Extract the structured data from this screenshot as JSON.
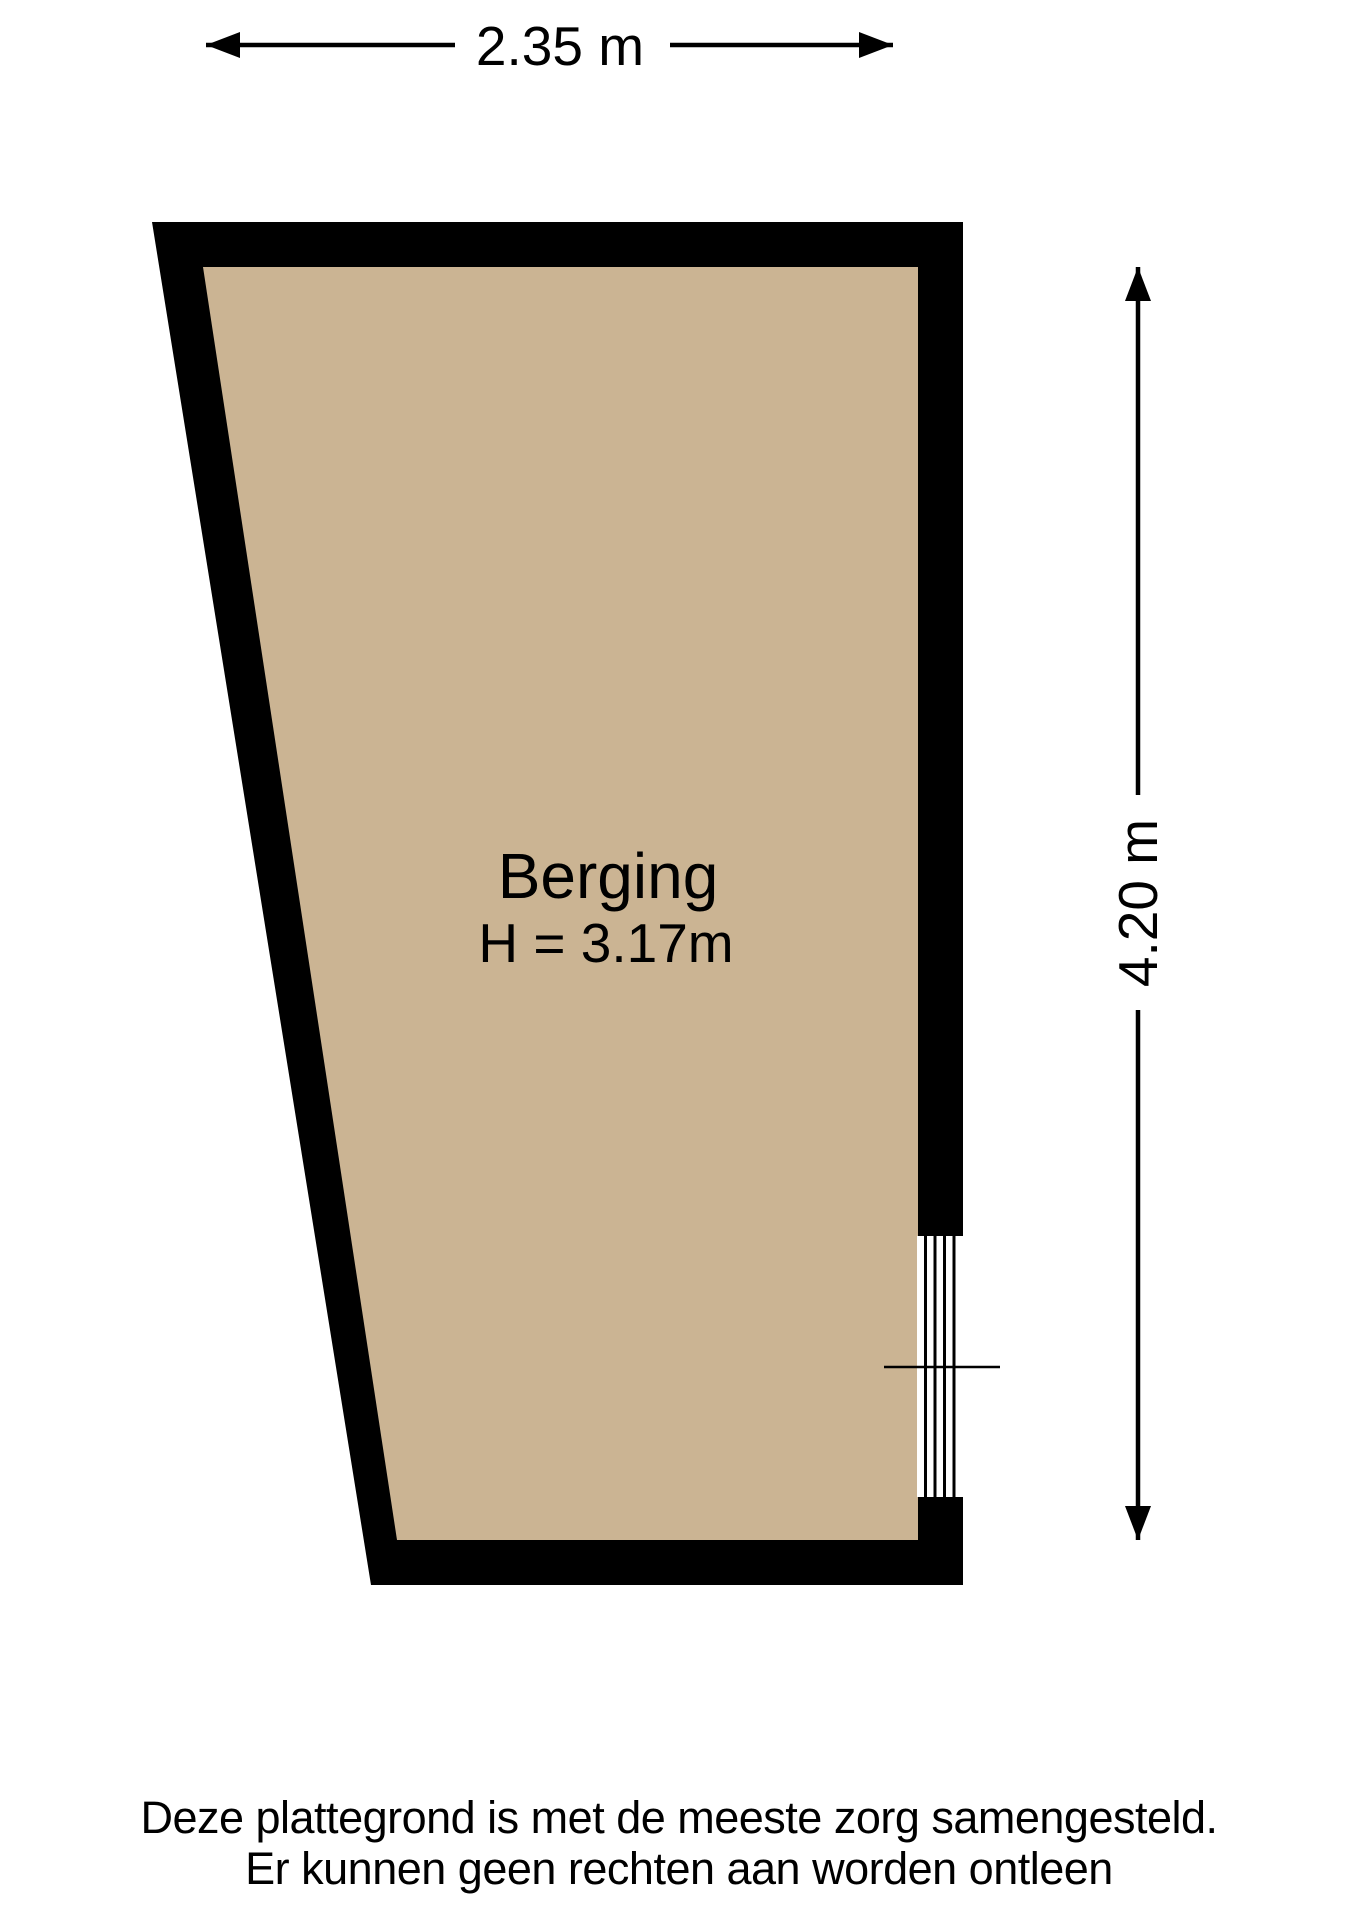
{
  "plan": {
    "room": {
      "name": "Berging",
      "ceiling_height_label": "H = 3.17m"
    },
    "dimensions": {
      "width_label": "2.35 m",
      "depth_label": "4.20 m"
    }
  },
  "footer": {
    "line1": "Deze plattegrond is met de meeste zorg samengesteld.",
    "line2": "Er kunnen geen rechten aan worden ontleen"
  },
  "colors": {
    "wall": "#000000",
    "floor": "#cbb493",
    "dimension_line": "#000000",
    "background": "#ffffff"
  }
}
